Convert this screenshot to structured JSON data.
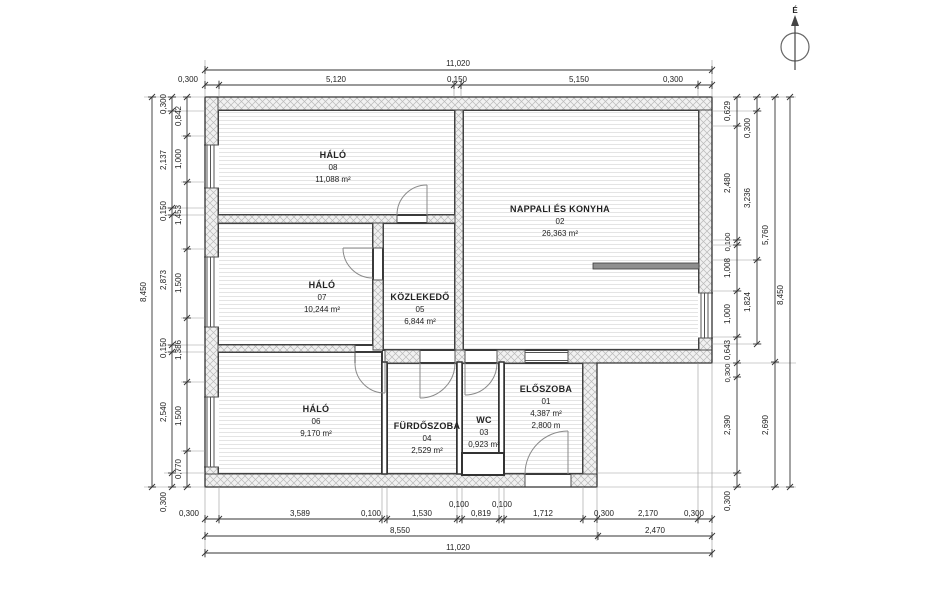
{
  "plan": {
    "north_label": "É",
    "rooms": [
      {
        "name": "HÁLÓ",
        "number": "08",
        "area": "11,088 m²"
      },
      {
        "name": "NAPPALI ÉS KONYHA",
        "number": "02",
        "area": "26,363 m²"
      },
      {
        "name": "HÁLÓ",
        "number": "07",
        "area": "10,244 m²"
      },
      {
        "name": "KÖZLEKEDŐ",
        "number": "05",
        "area": "6,844 m²"
      },
      {
        "name": "HÁLÓ",
        "number": "06",
        "area": "9,170 m²"
      },
      {
        "name": "FÜRDŐSZOBA",
        "number": "04",
        "area": "2,529 m²"
      },
      {
        "name": "WC",
        "number": "03",
        "area": "0,923 m²"
      },
      {
        "name": "ELŐSZOBA",
        "number": "01",
        "area": "4,387 m²",
        "height": "2,800 m"
      }
    ],
    "dims": {
      "top_total": "11,020",
      "top_row": [
        "0,300",
        "5,120",
        "0,150",
        "5,150",
        "0,300"
      ],
      "bottom_row": [
        "0,300",
        "3,589",
        "0,100",
        "1,530",
        "0,100",
        "0,819",
        "0,100",
        "1,712",
        "0,300",
        "2,170",
        "0,300"
      ],
      "bottom_mid": [
        "8,550",
        "2,470"
      ],
      "bottom_total": "11,020",
      "left_outer": "8,450",
      "left_mid": [
        "0,300",
        "2,137",
        "0,150",
        "2,873",
        "0,150",
        "2,540",
        "0,300"
      ],
      "left_inner": [
        "0,842",
        "1,000",
        "1,453",
        "1,500",
        "1,386",
        "1,500",
        "0,770"
      ],
      "right_inner": [
        "0,629",
        "2,480",
        "0,100",
        "1,008",
        "1,000",
        "0,643",
        "0,300",
        "2,390",
        "0,300"
      ],
      "right_mid": [
        "0,300",
        "3,236",
        "1,824"
      ],
      "right_col3": [
        "5,760",
        "2,690"
      ],
      "right_outer": "8,450"
    }
  }
}
